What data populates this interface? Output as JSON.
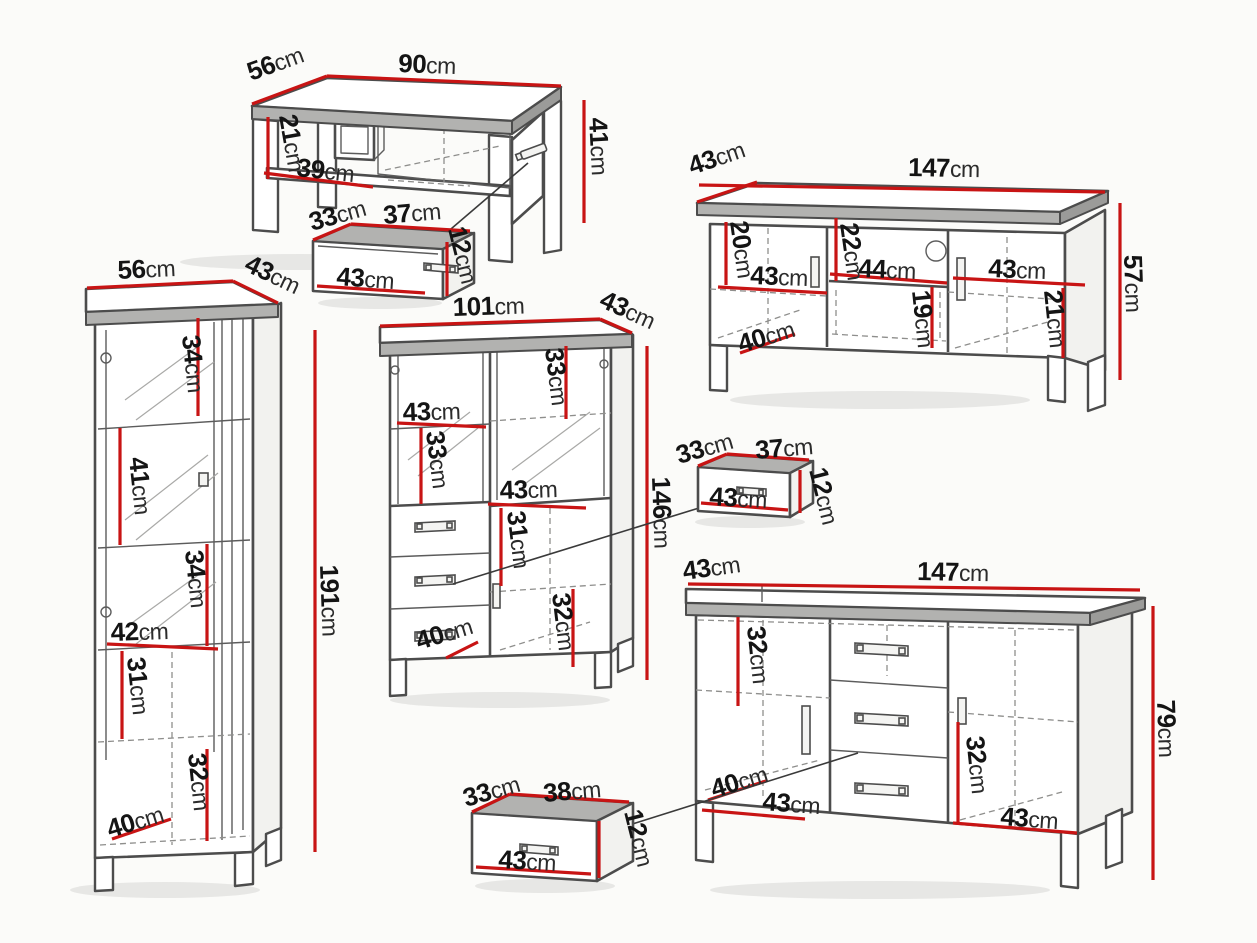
{
  "unit": "cm",
  "colors": {
    "dimension_line": "#c81414",
    "outline": "#4c4c4c",
    "background": "#fbfbf9"
  },
  "pieces": {
    "coffee_table": {
      "width": "90",
      "depth": "56",
      "height": "41",
      "shelf_clearance": "21",
      "shelf_width": "39"
    },
    "drawer_box_top": {
      "depth": "33",
      "width": "37",
      "height": "12",
      "front_width": "43"
    },
    "tv_stand": {
      "depth": "43",
      "width": "147",
      "height": "57",
      "left_clearance": "20",
      "left_door_width": "43",
      "mid_clearance": "22",
      "niche_width": "44",
      "right_door_width": "43",
      "floor_depth": "40",
      "niche_height": "19",
      "right_clearance": "21"
    },
    "vitrine": {
      "width": "56",
      "depth": "43",
      "height": "191",
      "top_shelf": "34",
      "second_shelf": "41",
      "third_shelf": "34",
      "inner_width": "42",
      "fourth_shelf": "31",
      "bottom_shelf": "32",
      "floor_depth": "40"
    },
    "cabinet": {
      "width": "101",
      "depth": "43",
      "height": "146",
      "left_door_width": "43",
      "right_shelf": "33",
      "left_shelf": "33",
      "mid_width": "43",
      "mid_clearance": "31",
      "bottom_clearance": "32",
      "floor_depth": "40"
    },
    "drawer_box_mid": {
      "depth": "33",
      "width": "37",
      "height": "12",
      "front_width": "43"
    },
    "sideboard": {
      "depth": "43",
      "width": "147",
      "height": "79",
      "left_clearance": "32",
      "floor_depth": "40",
      "left_door_width": "43",
      "right_clearance": "32",
      "right_door_width": "43"
    },
    "drawer_box_bottom": {
      "depth": "33",
      "width": "38",
      "height": "12",
      "front_width": "43"
    }
  }
}
